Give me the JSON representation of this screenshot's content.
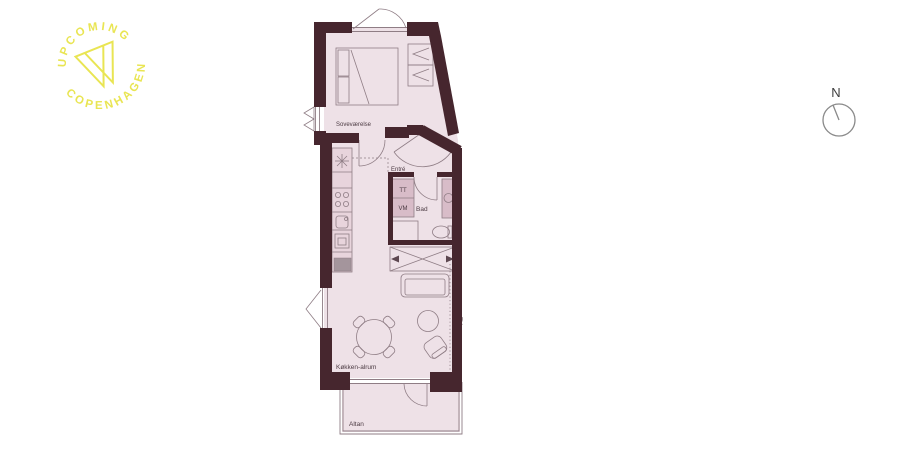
{
  "logo": {
    "arc_top": "UPCOMING",
    "arc_bottom": "COPENHAGEN",
    "color": "#e9e553"
  },
  "compass": {
    "north_label": "N"
  },
  "floorplan": {
    "labels": {
      "bedroom": "Soveværelse",
      "entry": "Entré",
      "dryer": "TT",
      "washer": "VM",
      "bathroom": "Bad",
      "tv": "TV",
      "kitchen_living": "Køkken-alrum",
      "balcony": "Altan"
    },
    "colors": {
      "wall": "#46262e",
      "floor": "#eee1e7",
      "counter": "#e8d4dc",
      "fixture": "#d8bcc8",
      "line": "#8f7d85"
    }
  }
}
